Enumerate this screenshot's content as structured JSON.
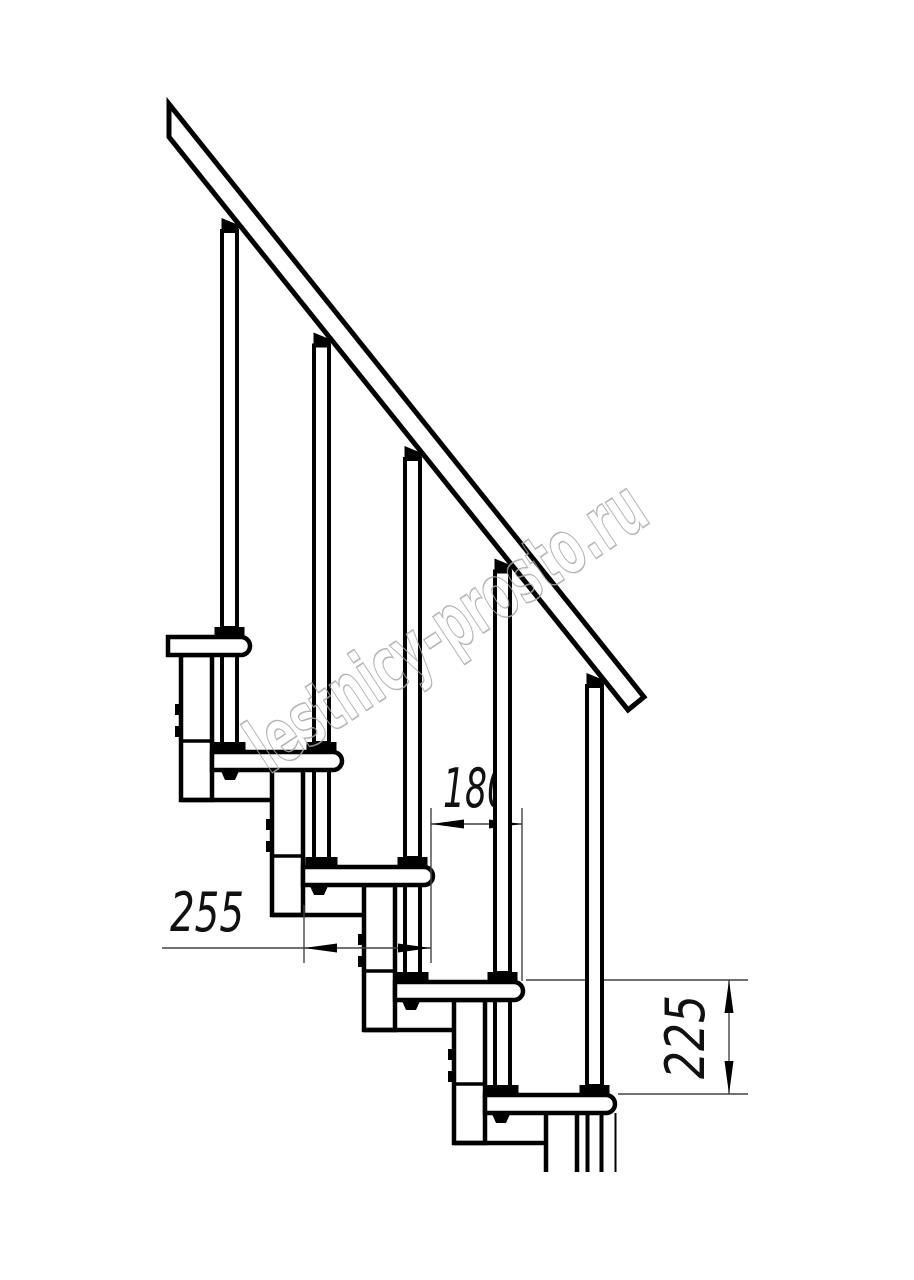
{
  "drawing": {
    "type": "technical-drawing",
    "subject": "modular staircase side elevation",
    "dimensions": {
      "tread_depth": "255",
      "step_run": "180",
      "step_rise": "225"
    },
    "watermark": "lestnicy-prosto.ru",
    "colors": {
      "line": "#000000",
      "dimension_line": "#444444",
      "dimension_text": "#111111",
      "watermark": "#a8a8a8",
      "background": "#ffffff"
    }
  }
}
